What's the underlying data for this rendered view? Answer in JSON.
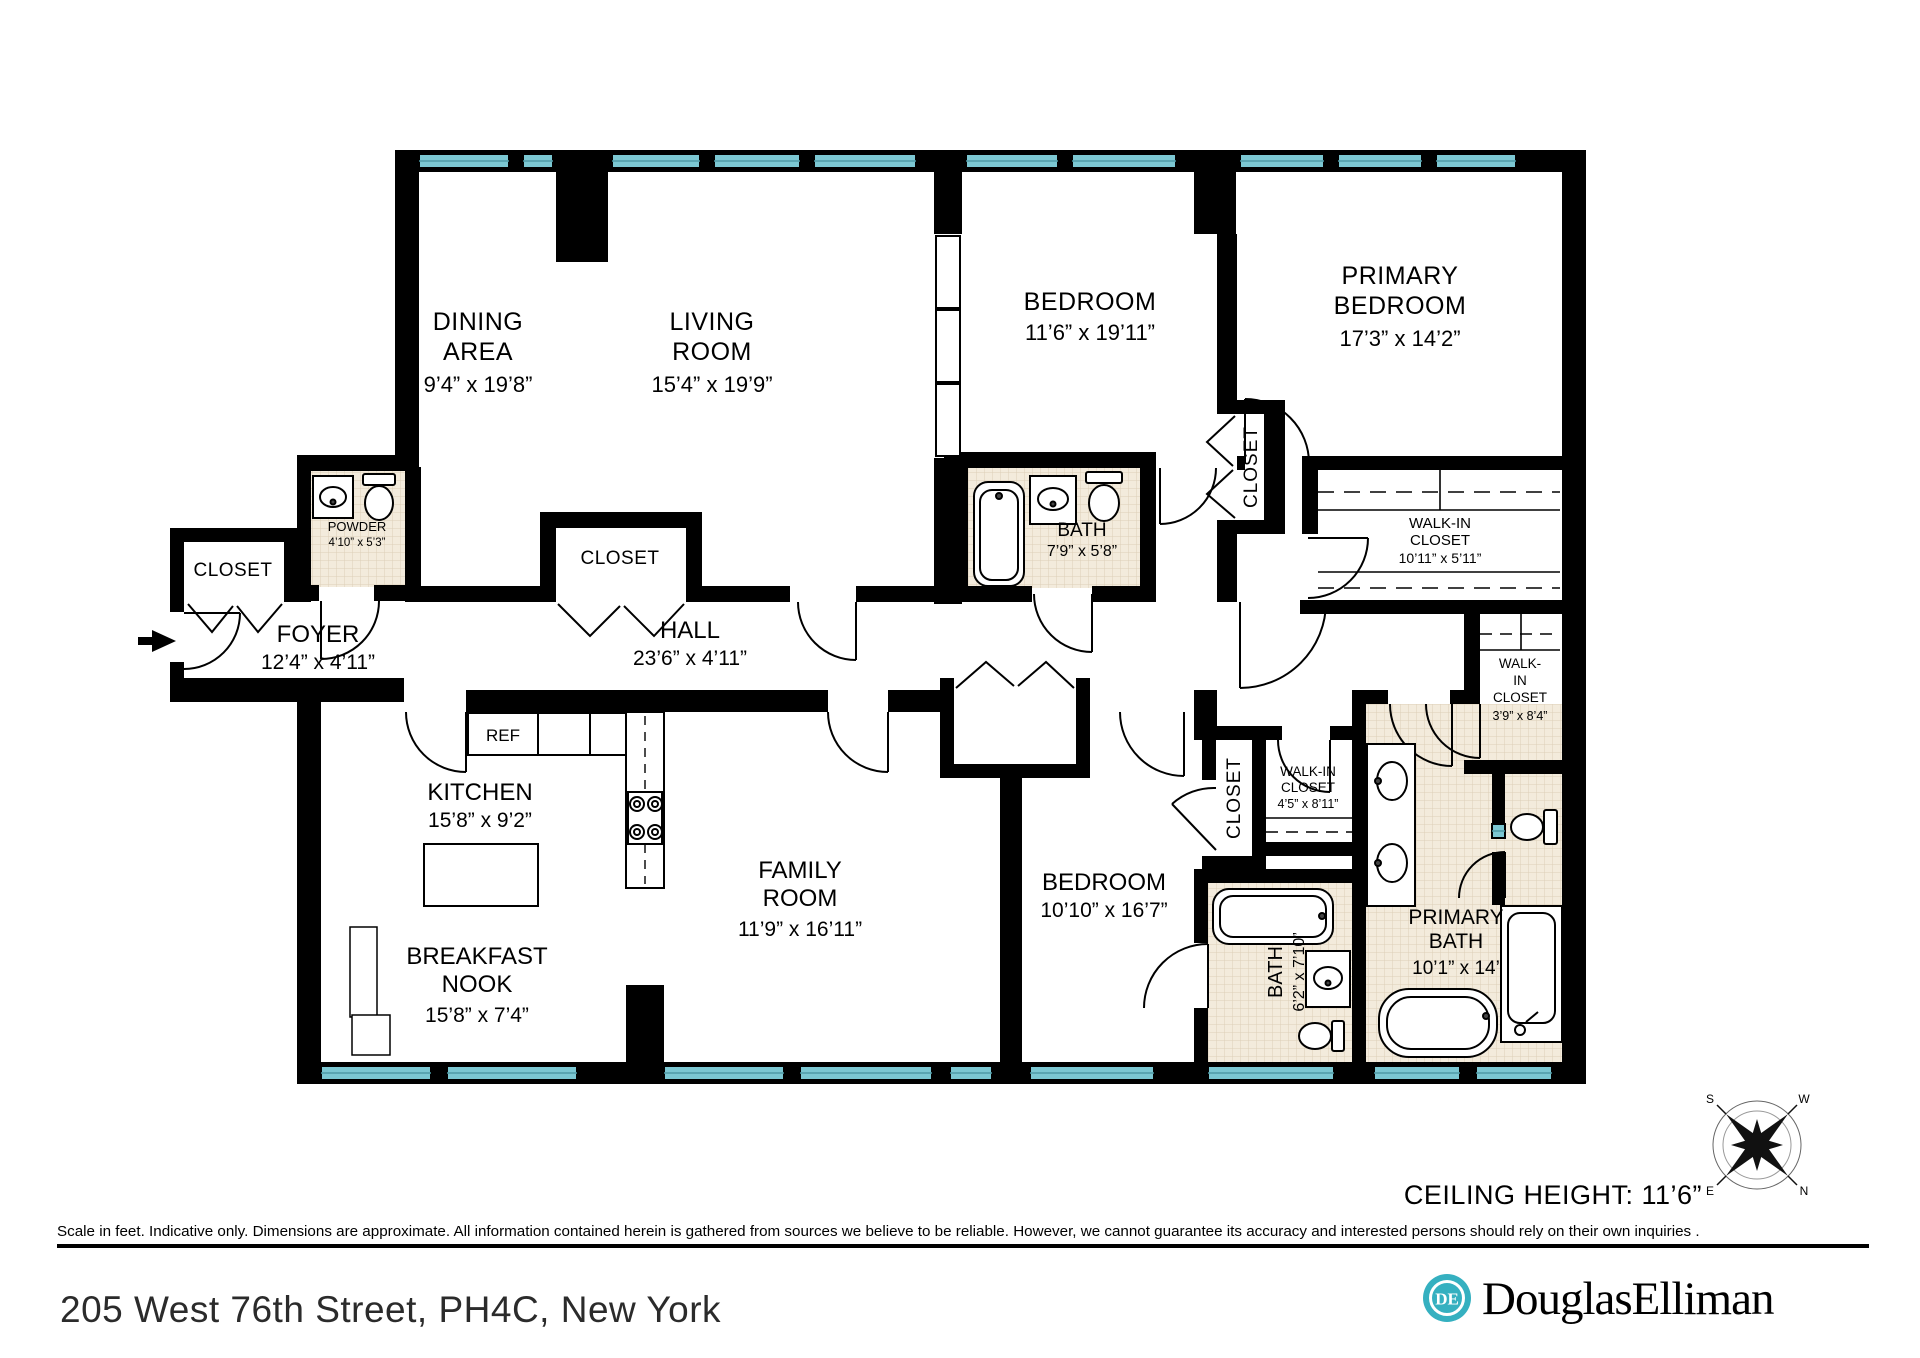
{
  "plan": {
    "rooms": {
      "dining": {
        "line1": "DINING",
        "line2": "AREA",
        "dims": "9’4” x 19’8”"
      },
      "living": {
        "line1": "LIVING",
        "line2": "ROOM",
        "dims": "15’4” x 19’9”"
      },
      "bedroom1": {
        "name": "BEDROOM",
        "dims": "11’6” x 19’11”"
      },
      "primary_bedroom": {
        "line1": "PRIMARY",
        "line2": "BEDROOM",
        "dims": "17’3” x 14’2”"
      },
      "bath1": {
        "name": "BATH",
        "dims": "7’9” x 5’8”"
      },
      "powder": {
        "name": "POWDER",
        "dims": "4’10” x 5’3”"
      },
      "foyer": {
        "name": "FOYER",
        "dims": "12’4” x 4’11”"
      },
      "hall": {
        "name": "HALL",
        "dims": "23’6” x 4’11”"
      },
      "kitchen": {
        "name": "KITCHEN",
        "dims": "15’8” x 9’2”"
      },
      "breakfast_nook": {
        "line1": "BREAKFAST",
        "line2": "NOOK",
        "dims": "15’8” x 7’4”"
      },
      "family_room": {
        "line1": "FAMILY",
        "line2": "ROOM",
        "dims": "11’9” x 16’11”"
      },
      "bedroom2": {
        "name": "BEDROOM",
        "dims": "10’10” x 16’7”"
      },
      "bath2": {
        "name": "BATH",
        "dims": "6’2” x 7’10”"
      },
      "primary_bath": {
        "line1": "PRIMARY",
        "line2": "BATH",
        "dims": "10’1” x 14’"
      },
      "walk_in_primary": {
        "line1": "WALK-IN",
        "line2": "CLOSET",
        "dims": "10’11” x 5’11”"
      },
      "walk_in_39": {
        "line1": "WALK-",
        "line2": "IN",
        "line3": "CLOSET",
        "dims": "3’9” x 8’4”"
      },
      "walk_in_45": {
        "line1": "WALK-IN",
        "line2": "CLOSET",
        "dims": "4’5” x 8’11”"
      },
      "closet_foyer": "CLOSET",
      "closet_hall": "CLOSET",
      "closet_bed1": "CLOSET",
      "closet_bed2": "CLOSET",
      "ref": "REF"
    },
    "compass": {
      "n": "N",
      "s": "S",
      "e": "E",
      "w": "W"
    },
    "ceiling_height": "CEILING HEIGHT: 11’6”"
  },
  "footer": {
    "disclaimer": "Scale in feet. Indicative only. Dimensions are approximate. All information contained herein is gathered from sources we believe to be reliable. However, we cannot guarantee its accuracy and interested persons should rely on their own inquiries .",
    "address": "205 West 76th Street, PH4C, New York",
    "brand": {
      "wordmark": "DouglasElliman",
      "monogram": "DE",
      "teal": "#35b0c0",
      "navy": "#1b2b4c"
    }
  },
  "colors": {
    "wall": "#000000",
    "window": "#7cc7d2",
    "tile": "#f3ebdc"
  }
}
